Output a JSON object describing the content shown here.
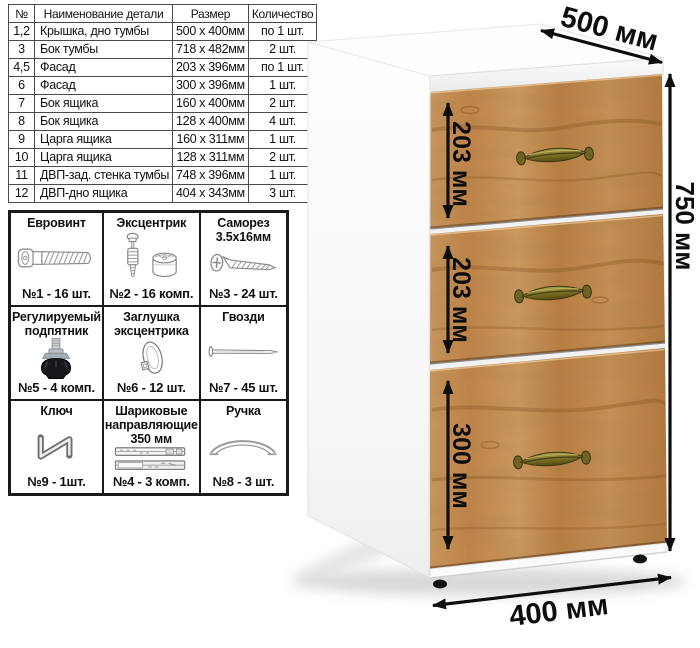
{
  "parts_table": {
    "headers": [
      "№",
      "Наименование детали",
      "Размер",
      "Количество"
    ],
    "rows": [
      [
        "1,2",
        "Крышка, дно тумбы",
        "500 x 400мм",
        "по 1 шт."
      ],
      [
        "3",
        "Бок тумбы",
        "718 x 482мм",
        "2 шт."
      ],
      [
        "4,5",
        "Фасад",
        "203 x 396мм",
        "по 1 шт."
      ],
      [
        "6",
        "Фасад",
        "300 x 396мм",
        "1 шт."
      ],
      [
        "7",
        "Бок ящика",
        "160 x 400мм",
        "2 шт."
      ],
      [
        "8",
        "Бок ящика",
        "128 x 400мм",
        "4 шт."
      ],
      [
        "9",
        "Царга ящика",
        "160 x 311мм",
        "1 шт."
      ],
      [
        "10",
        "Царга ящика",
        "128 x 311мм",
        "2 шт."
      ],
      [
        "11",
        "ДВП-зад. стенка тумбы",
        "748 x 396мм",
        "1 шт."
      ],
      [
        "12",
        "ДВП-дно ящика",
        "404 x 343мм",
        "3 шт."
      ]
    ]
  },
  "hardware": {
    "cells": [
      {
        "title": "Евровинт",
        "icon": "eurovint",
        "label": "№1 - 16 шт."
      },
      {
        "title": "Эксцентрик",
        "icon": "eccentric-cam",
        "label": "№2 - 16 комп."
      },
      {
        "title": "Саморез\n3.5х16мм",
        "icon": "screw",
        "label": "№3 - 24 шт."
      },
      {
        "title": "Регулируемый\nподпятник",
        "icon": "adjustable-foot",
        "label": "№5 - 4 комп."
      },
      {
        "title": "Заглушка\nэксцентрика",
        "icon": "cam-cover",
        "label": "№6 - 12 шт."
      },
      {
        "title": "Гвозди",
        "icon": "nail",
        "label": "№7 - 45 шт."
      },
      {
        "title": "Ключ",
        "icon": "hex-key",
        "label": "№9 - 1шт."
      },
      {
        "title": "Шариковые\nнаправляющие\n350 мм",
        "icon": "ball-slides",
        "label": "№4 - 3 комп."
      },
      {
        "title": "Ручка",
        "icon": "handle",
        "label": "№8 - 3 шт."
      }
    ]
  },
  "cabinet": {
    "depth_label": "500 мм",
    "height_label": "750 мм",
    "width_label": "400 мм",
    "drawer_labels": [
      "203 мм",
      "203 мм",
      "300 мм"
    ],
    "wood_color": "#c08347",
    "handle_color": "#7c7026",
    "dimension_color": "#0e0e0e"
  }
}
